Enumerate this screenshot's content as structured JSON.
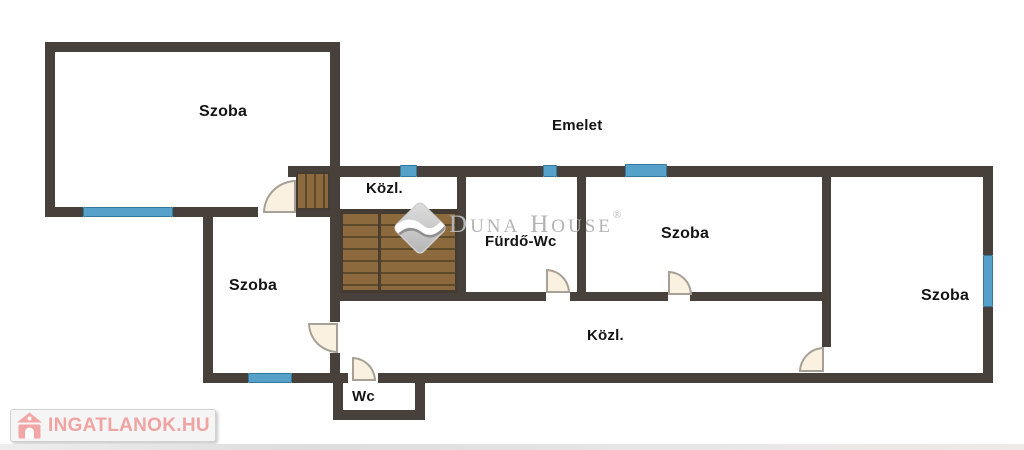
{
  "floor_plan": {
    "title": "Emelet",
    "rooms": {
      "room_top_left": "Szoba",
      "room_lower_left": "Szoba",
      "room_middle": "Szoba",
      "room_right": "Szoba",
      "bathroom": "Fürdő-Wc",
      "hall_upper": "Közl.",
      "hall_lower": "Közl.",
      "wc": "Wc"
    }
  },
  "watermark": {
    "d": "D",
    "una": "UNA",
    "h": "H",
    "ouse": "OUSE",
    "registered": "®"
  },
  "logo": {
    "text": "INGATLANOK.HU"
  },
  "colors": {
    "wall": "#48403a",
    "window_blue": "#55a1c9",
    "stair_wood": "#8c6a3e",
    "stair_tread": "#5d4a2a",
    "door_fill": "#faf1e0",
    "watermark_gray": "#b4b4b4",
    "logo_red": "#f0a3a3"
  }
}
